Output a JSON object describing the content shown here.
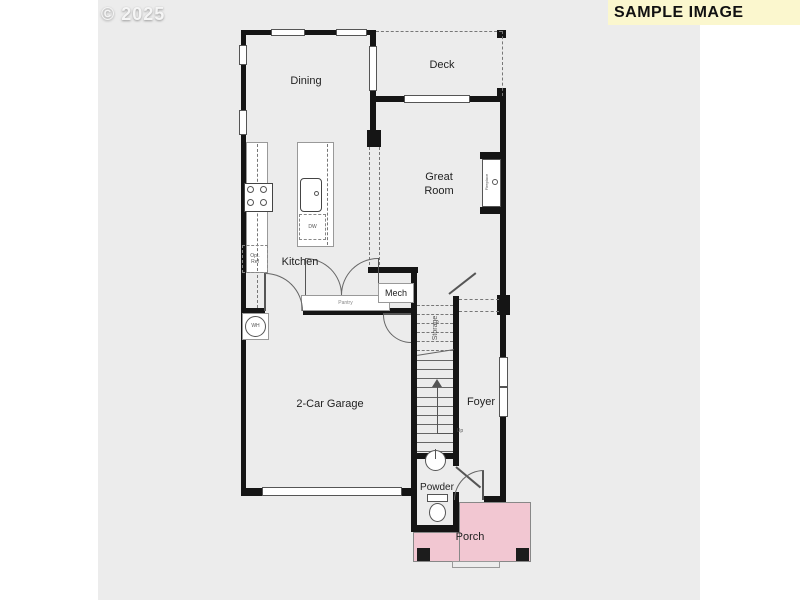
{
  "banner": {
    "label": "SAMPLE IMAGE"
  },
  "watermark": "© 2025",
  "colors": {
    "panel_bg": "#ECECEC",
    "banner_bg": "#FBF7CE",
    "wall": "#151515",
    "porch": "#F2C7D2",
    "post": "#1C1C1C"
  },
  "rooms": {
    "dining": "Dining",
    "deck": "Deck",
    "great_1": "Great",
    "great_2": "Room",
    "kitchen": "Kitchen",
    "mech": "Mech",
    "storage": "Storage",
    "pantry": "Pantry",
    "garage": "2-Car Garage",
    "foyer": "Foyer",
    "powder": "Powder",
    "porch": "Porch"
  },
  "fixtures": {
    "dw": "DW",
    "wh": "WH",
    "opt_ref_1": "Opt.",
    "opt_ref_2": "Ref",
    "fireplace": "Fireplace",
    "up": "Up"
  }
}
